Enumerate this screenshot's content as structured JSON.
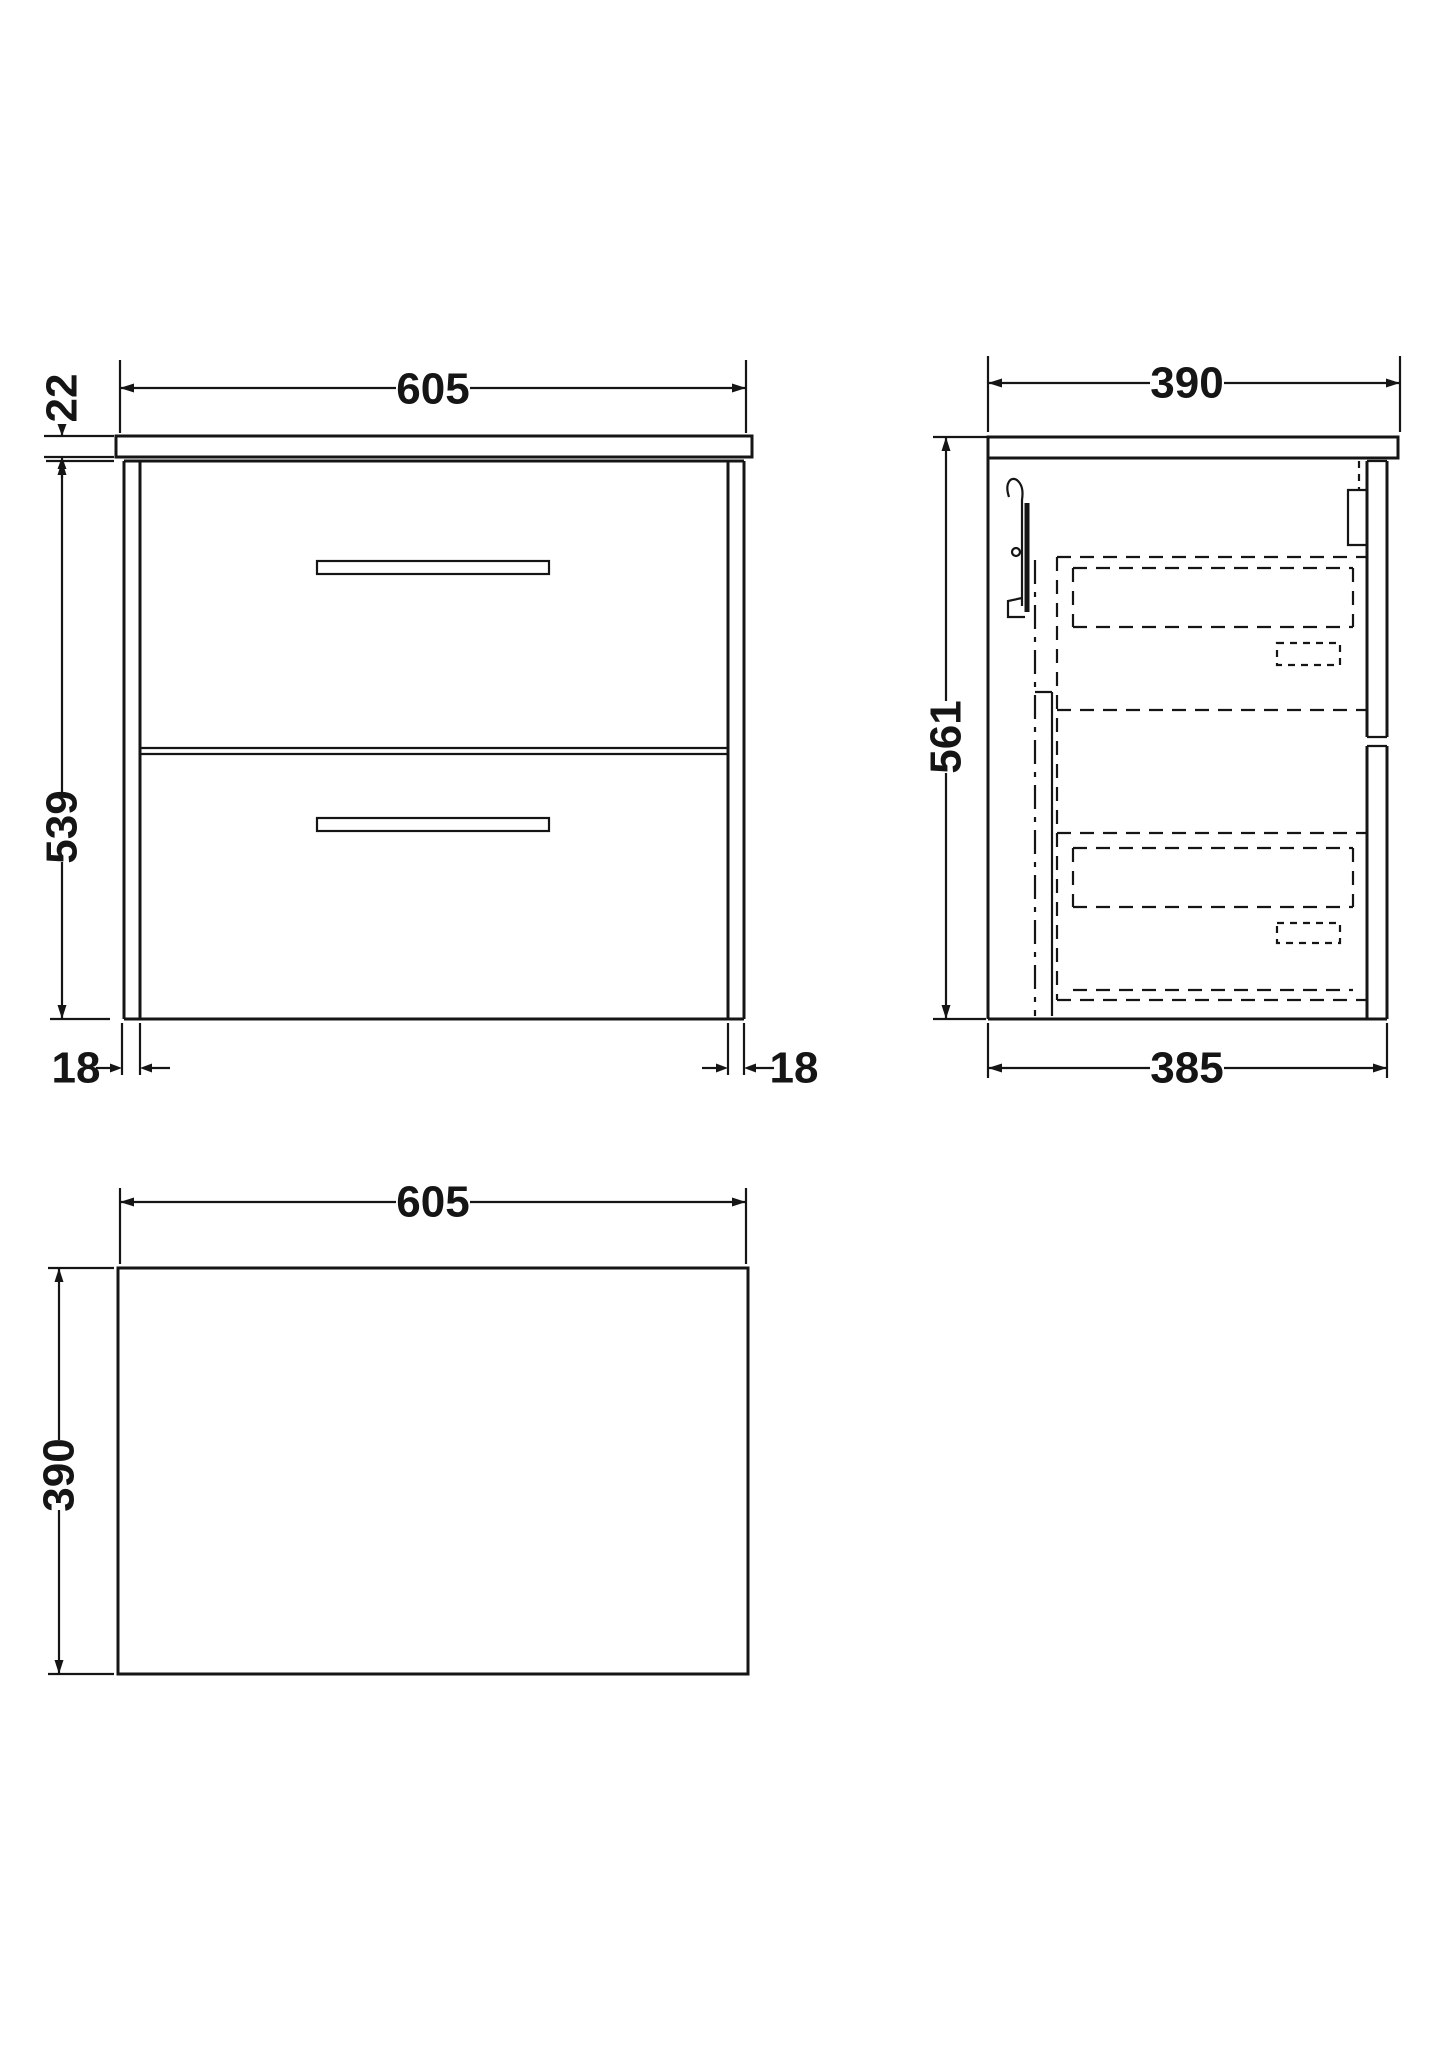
{
  "drawing": {
    "background": "#ffffff",
    "line_color": "#151515",
    "views": {
      "front": {
        "label": "front-elevation",
        "dim_top_width": "605",
        "dim_countertop_thickness": "22",
        "dim_cabinet_height": "539",
        "dim_panel_left": "18",
        "dim_panel_right": "18"
      },
      "side": {
        "label": "side-elevation",
        "dim_top_depth": "390",
        "dim_height": "561",
        "dim_bottom_depth": "385"
      },
      "plan": {
        "label": "plan-view",
        "dim_width": "605",
        "dim_depth": "390"
      }
    }
  }
}
